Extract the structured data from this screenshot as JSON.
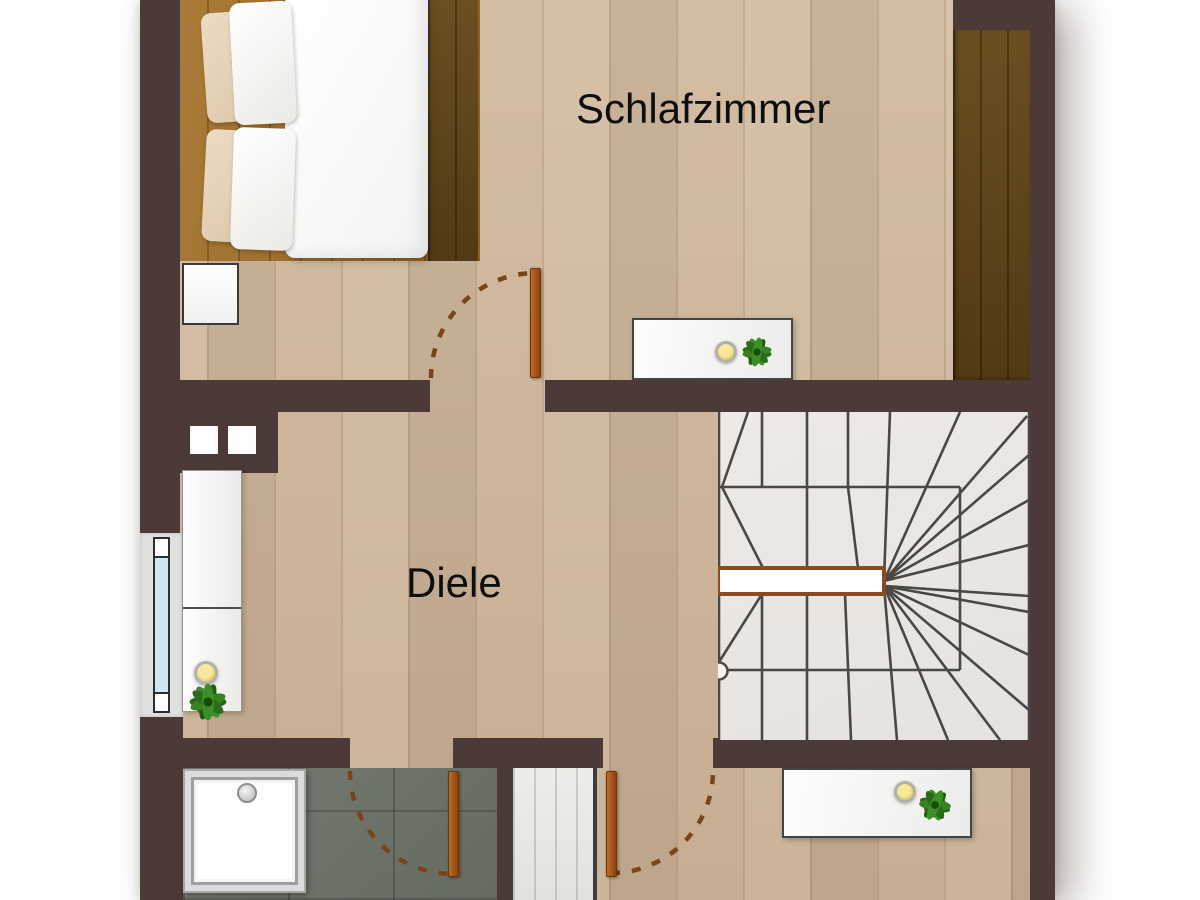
{
  "floorplan": {
    "rooms": {
      "bedroom": {
        "label": "Schlafzimmer"
      },
      "hallway": {
        "label": "Diele"
      }
    },
    "colors": {
      "wall": "#4b3a37",
      "floor": "#ccb59a",
      "tile": "#71766e",
      "door": "#b05a1d",
      "swing": "#7a4418",
      "stairs": "#e9e7e4",
      "glass": "#cfe6ee"
    },
    "features": [
      "double-bed",
      "nightstand",
      "wardrobe",
      "bedroom-sideboard",
      "winder-staircase",
      "handrail",
      "newel-post",
      "hallway-cabinet",
      "window",
      "chimney-flues",
      "shower",
      "bathroom",
      "storage-room",
      "plants",
      "candles",
      "door-swings"
    ]
  }
}
